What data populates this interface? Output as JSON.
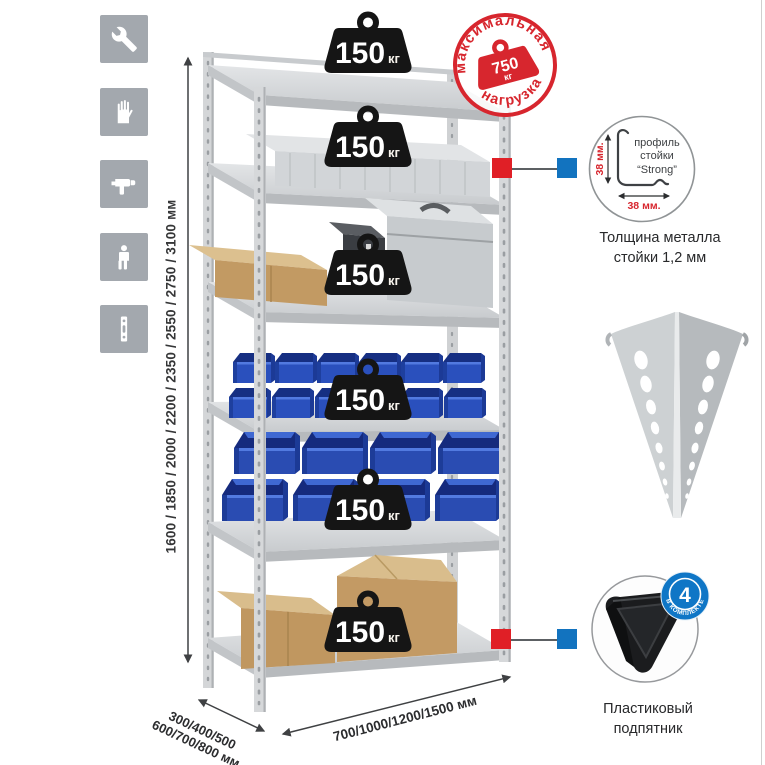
{
  "sidebar": {
    "icons": [
      {
        "name": "wrench"
      },
      {
        "name": "gloves"
      },
      {
        "name": "drill"
      },
      {
        "name": "person"
      },
      {
        "name": "perforated-profile"
      }
    ]
  },
  "height_dimension": {
    "label": "1600 / 1850 / 2000 / 2200 / 2350 / 2550 / 2750 / 3100 мм"
  },
  "width_dimension": {
    "label": "700/1000/1200/1500 мм"
  },
  "depth_dimension": {
    "line1": "300/400/500",
    "line2": "600/700/800 мм"
  },
  "max_load_badge": {
    "top_text": "максимальная",
    "bottom_text": "нагрузка",
    "value": "750",
    "unit": "кг"
  },
  "rack": {
    "shelf_count": 6,
    "loads": [
      {
        "value": "150",
        "unit": "кг"
      },
      {
        "value": "150",
        "unit": "кг"
      },
      {
        "value": "150",
        "unit": "кг"
      },
      {
        "value": "150",
        "unit": "кг"
      },
      {
        "value": "150",
        "unit": "кг"
      },
      {
        "value": "150",
        "unit": "кг"
      }
    ]
  },
  "strong_profile": {
    "label_line1": "профиль",
    "label_line2": "стойки",
    "label_line3": "“Strong”",
    "vertical_dim": "38 мм.",
    "horizontal_dim": "38 мм.",
    "caption_line1": "Толщина металла",
    "caption_line2": "стойки 1,2 мм"
  },
  "foot": {
    "badge_count": "4",
    "badge_text": "В КОМПЛЕКТЕ",
    "caption_line1": "Пластиковый",
    "caption_line2": "подпятник"
  },
  "colors": {
    "accent_red": "#d7262e",
    "marker_red": "#e01f26",
    "marker_blue": "#1273bf",
    "badge_blue": "#0f76c6",
    "bin_blue": "#2a4fb8",
    "metal_gray": "#d2d4d6",
    "icon_gray": "#a3a8ae",
    "cardboard": "#c29a63"
  }
}
